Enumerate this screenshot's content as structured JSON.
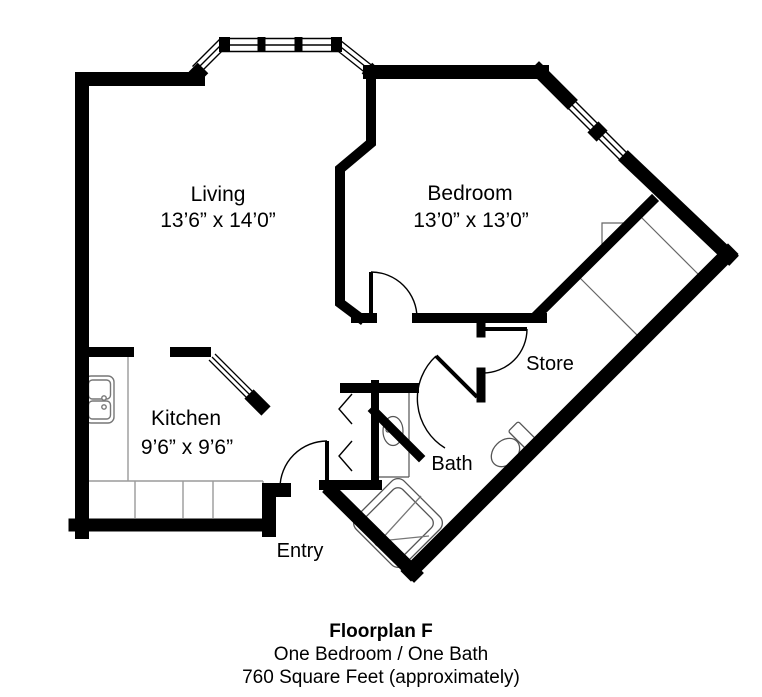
{
  "floorplan": {
    "rooms": [
      {
        "name": "Living",
        "dimensions": "13’6” x 14’0”"
      },
      {
        "name": "Bedroom",
        "dimensions": "13’0” x 13’0”"
      },
      {
        "name": "Kitchen",
        "dimensions": "9’6” x 9’6”"
      },
      {
        "name": "Store",
        "dimensions": ""
      },
      {
        "name": "Bath",
        "dimensions": ""
      },
      {
        "name": "Entry",
        "dimensions": ""
      }
    ],
    "caption": {
      "title": "Floorplan F",
      "line2": "One Bedroom / One Bath",
      "line3": "760 Square Feet (approximately)"
    },
    "colors": {
      "walls": "#000000",
      "background": "#ffffff"
    },
    "fixtures": [
      "kitchen-sink",
      "kitchen-counter",
      "vanity-sink",
      "toilet",
      "shower",
      "bifold-closet",
      "bay-window",
      "bedroom-window",
      "kitchen-pass-window"
    ]
  }
}
